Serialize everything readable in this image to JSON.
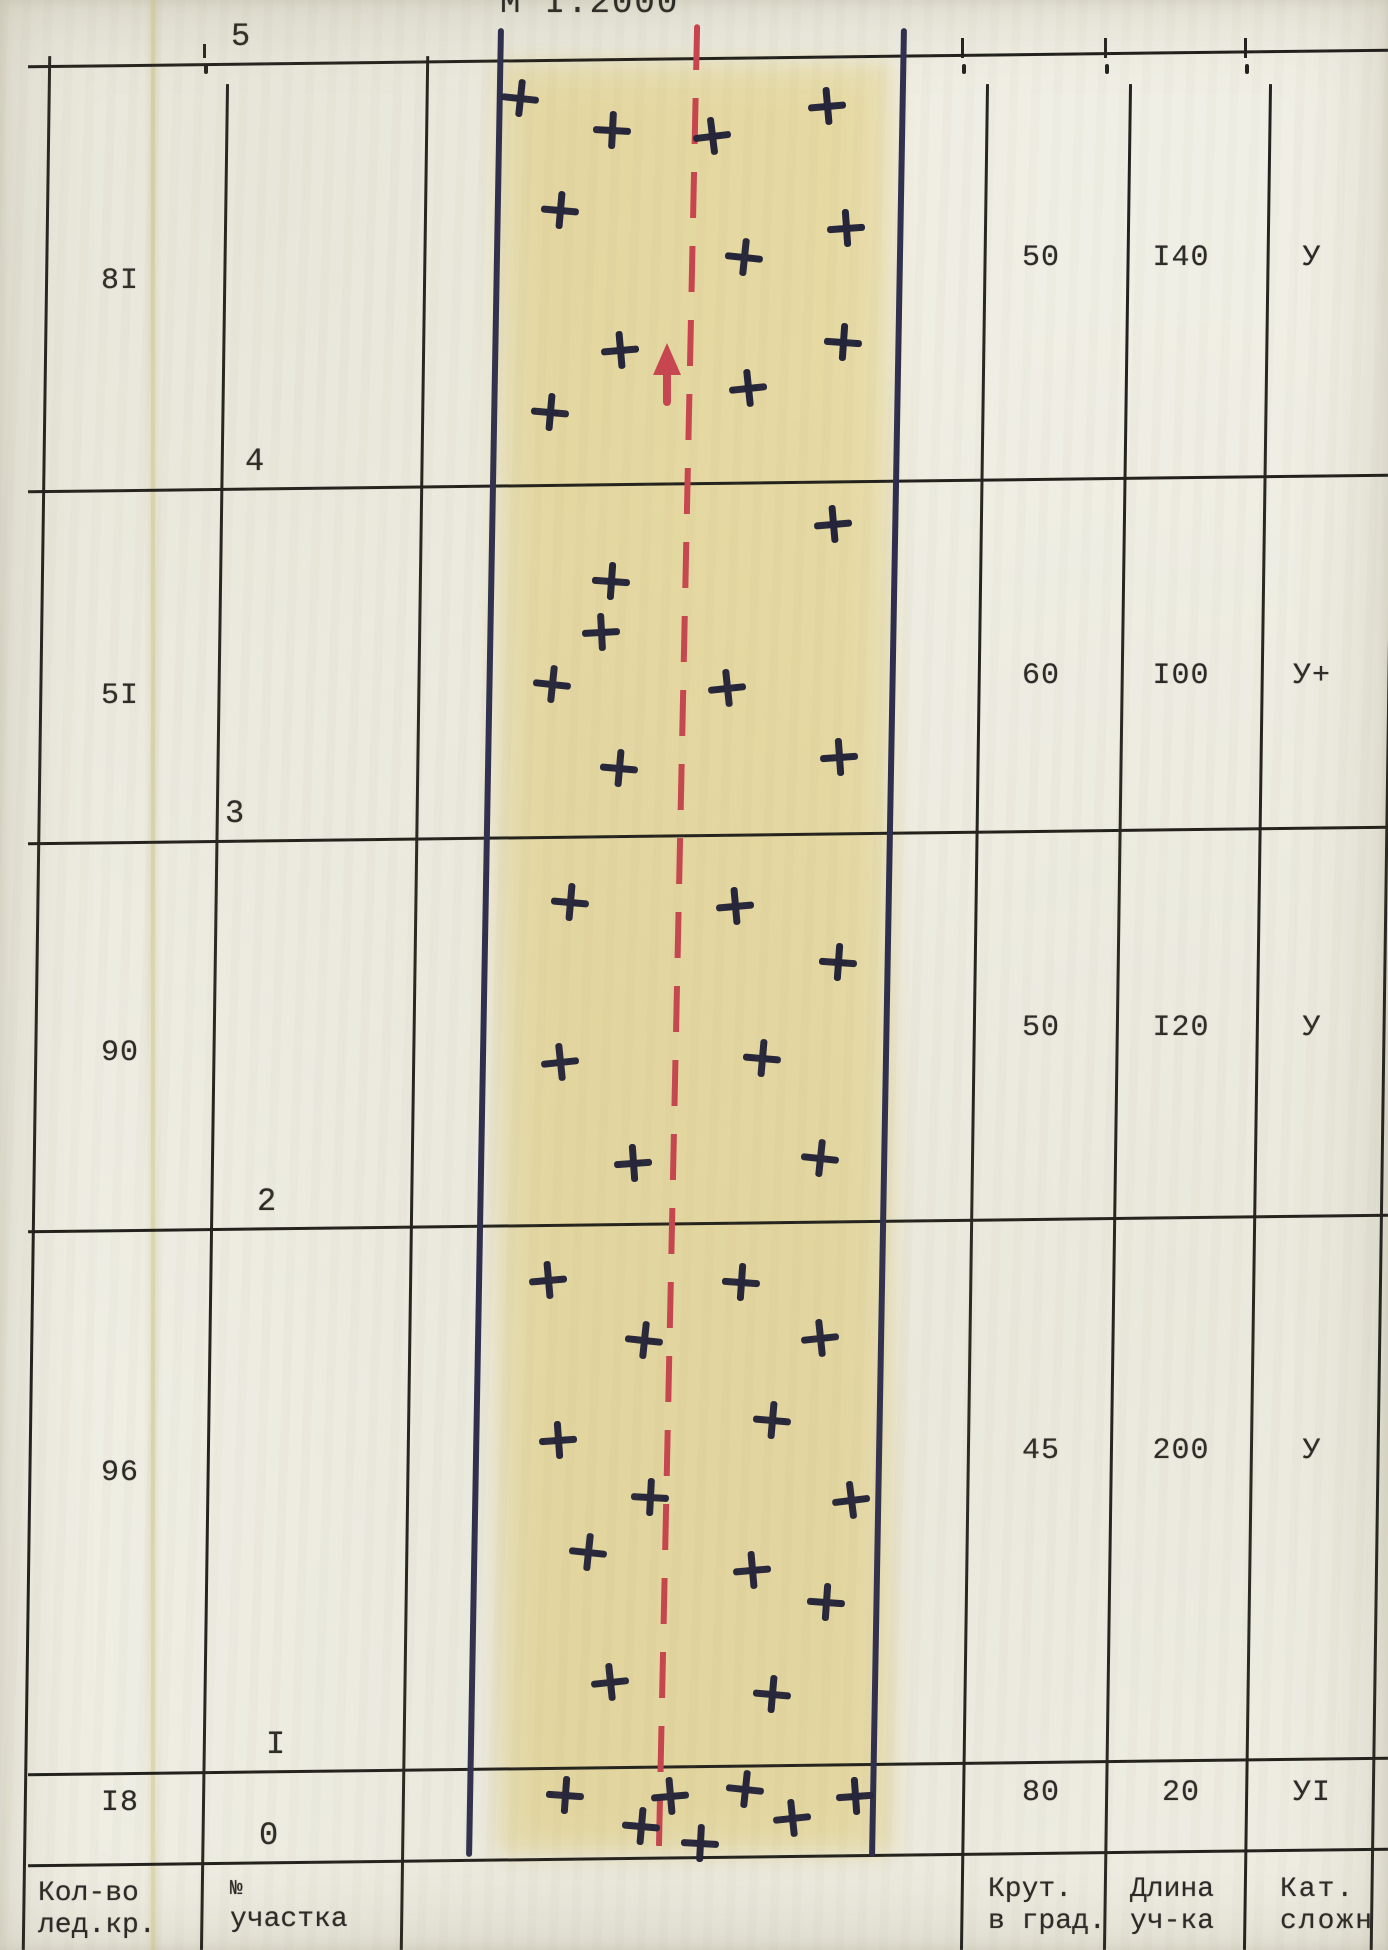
{
  "scale_label": "М I:2000",
  "table": {
    "headers": {
      "ice": [
        "Кол-во",
        "лед.кр."
      ],
      "section_no": [
        "№",
        "участка"
      ],
      "steepness": [
        "Крут.",
        "в град."
      ],
      "length": [
        "Длина",
        "уч-ка"
      ],
      "category": [
        "Кат.",
        "сложн"
      ]
    },
    "ticks": [
      {
        "label": "5",
        "x": 231,
        "y": 58
      },
      {
        "label": "4",
        "x": 245,
        "y": 483
      },
      {
        "label": "3",
        "x": 225,
        "y": 835
      },
      {
        "label": "2",
        "x": 257,
        "y": 1223
      },
      {
        "label": "I",
        "x": 266,
        "y": 1766
      },
      {
        "label": "0",
        "x": 259,
        "y": 1857
      }
    ],
    "rows": [
      {
        "ice_screws": "8I",
        "steepness": "50",
        "length": "I40",
        "category": "У",
        "y_right": 262,
        "y_left": 285
      },
      {
        "ice_screws": "5I",
        "steepness": "60",
        "length": "I00",
        "category": "У+",
        "y_right": 680,
        "y_left": 700
      },
      {
        "ice_screws": "90",
        "steepness": "50",
        "length": "I20",
        "category": "У",
        "y_right": 1032,
        "y_left": 1057
      },
      {
        "ice_screws": "96",
        "steepness": "45",
        "length": "200",
        "category": "У",
        "y_right": 1455,
        "y_left": 1477
      },
      {
        "ice_screws": "I8",
        "steepness": "80",
        "length": "20",
        "category": "УI",
        "y_right": 1797,
        "y_left": 1807
      }
    ]
  },
  "route": {
    "corridor_x": [
      485,
      888
    ],
    "center_line_x": 678,
    "arrow_tip_y": 345,
    "colors": {
      "ink": "#23233a",
      "route_line": "#ca4450",
      "corridor_line": "#2c2c4e",
      "wash": "#e4ce72"
    },
    "crosses": [
      [
        520,
        98,
        6
      ],
      [
        827,
        106,
        -5
      ],
      [
        612,
        130,
        3
      ],
      [
        712,
        136,
        -7
      ],
      [
        560,
        210,
        5
      ],
      [
        846,
        228,
        -4
      ],
      [
        744,
        257,
        6
      ],
      [
        620,
        350,
        -5
      ],
      [
        843,
        342,
        4
      ],
      [
        748,
        388,
        -6
      ],
      [
        550,
        412,
        5
      ],
      [
        833,
        524,
        -5
      ],
      [
        611,
        581,
        4
      ],
      [
        601,
        632,
        -3
      ],
      [
        552,
        684,
        6
      ],
      [
        727,
        688,
        -6
      ],
      [
        619,
        768,
        5
      ],
      [
        839,
        757,
        -4
      ],
      [
        570,
        902,
        5
      ],
      [
        735,
        906,
        -5
      ],
      [
        838,
        962,
        4
      ],
      [
        560,
        1062,
        -6
      ],
      [
        762,
        1058,
        5
      ],
      [
        633,
        1163,
        -4
      ],
      [
        820,
        1158,
        6
      ],
      [
        548,
        1280,
        -5
      ],
      [
        741,
        1282,
        4
      ],
      [
        644,
        1340,
        6
      ],
      [
        820,
        1338,
        -6
      ],
      [
        772,
        1420,
        5
      ],
      [
        558,
        1440,
        -4
      ],
      [
        650,
        1497,
        3
      ],
      [
        851,
        1500,
        -7
      ],
      [
        588,
        1552,
        6
      ],
      [
        752,
        1570,
        -5
      ],
      [
        826,
        1602,
        4
      ],
      [
        610,
        1682,
        -6
      ],
      [
        772,
        1694,
        5
      ],
      [
        565,
        1795,
        4
      ],
      [
        670,
        1796,
        -5
      ],
      [
        745,
        1789,
        6
      ],
      [
        855,
        1796,
        -4
      ],
      [
        641,
        1826,
        5
      ],
      [
        792,
        1818,
        -6
      ],
      [
        700,
        1843,
        3
      ]
    ]
  },
  "chart_data": {
    "type": "table",
    "title": "М I:2000",
    "columns": [
      "Кол-во лед.кр.",
      "№ участка",
      "Крут. в град.",
      "Длина уч-ка",
      "Кат. сложн"
    ],
    "rows": [
      [
        "8I",
        "4–5",
        "50",
        "I40",
        "У"
      ],
      [
        "5I",
        "3–4",
        "60",
        "I00",
        "У+"
      ],
      [
        "90",
        "2–3",
        "50",
        "I20",
        "У"
      ],
      [
        "96",
        "I–2",
        "45",
        "200",
        "У"
      ],
      [
        "I8",
        "0–I",
        "80",
        "20",
        "УI"
      ]
    ]
  }
}
